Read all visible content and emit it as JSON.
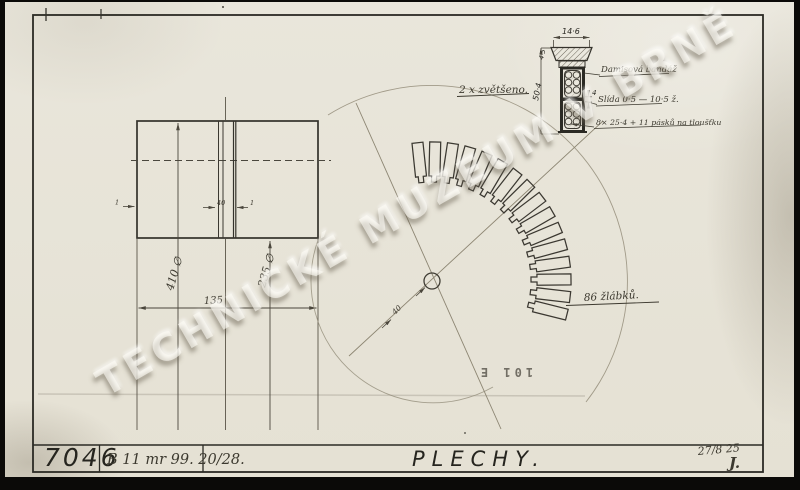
{
  "sheet": {
    "watermark": "TECHNICKÉ MUZEUM V BRNĚ",
    "stamp": "101 E"
  },
  "title_block": {
    "drawing_number": "7046",
    "reference": "B 11 mr 99. 20/28.",
    "title": "PLECHY.",
    "date": "27/8 25",
    "signature": "J."
  },
  "side_view": {
    "dim_outer_diameter": "410 ∅",
    "dim_inner_diameter": "235 ∅",
    "dim_width": "135",
    "dim_slot_width": "40",
    "dim_gap_left": "1",
    "dim_gap_right": "1"
  },
  "front_view": {
    "slot_count_label": "86 žlábků.",
    "dim_shaft": "40"
  },
  "detail_view": {
    "scale_label": "2 x zvětšeno.",
    "dim_top_width": "14·6",
    "dim_height": "50·4",
    "dim_wedge_height": "4·5",
    "dim_separator": "4",
    "note_1": "Damisová bandáž",
    "note_2": "Slída 0·5 — 10·5 ž.",
    "note_3": "8× 25·4 + 11 pásků na tloušťku"
  }
}
